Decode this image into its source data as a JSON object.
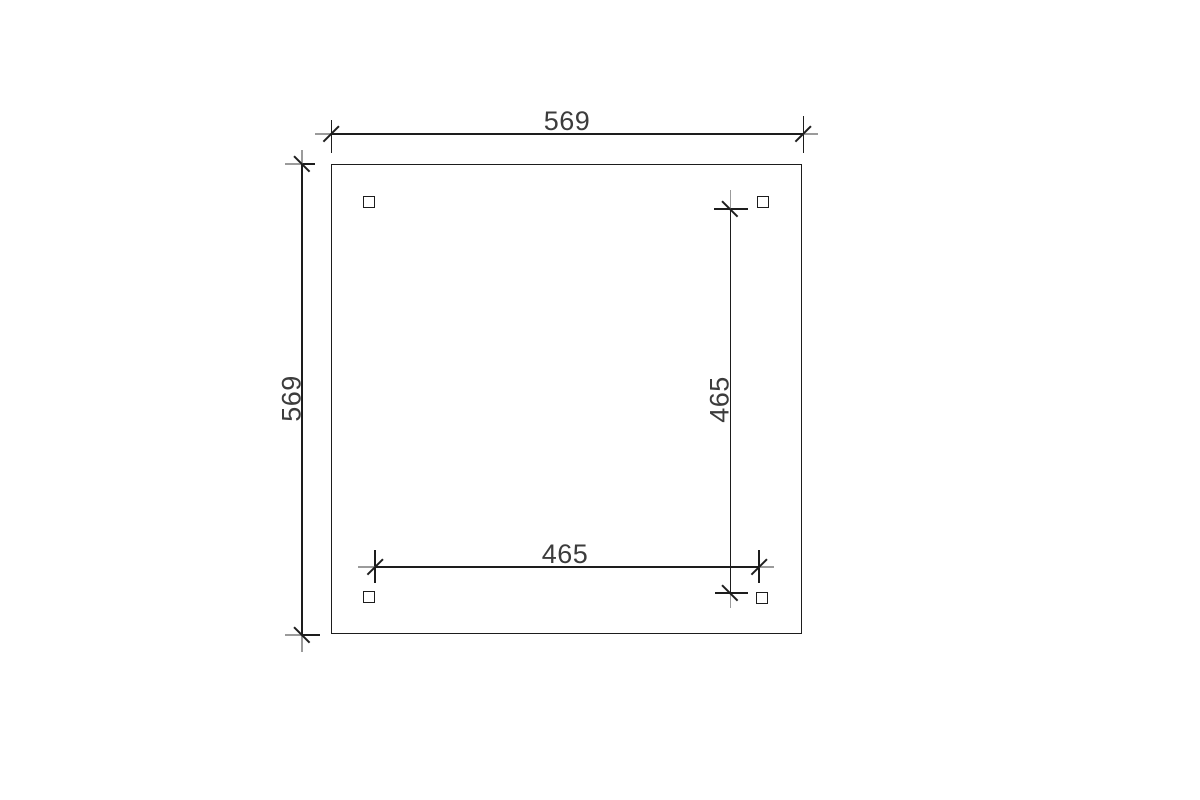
{
  "drawing": {
    "type": "plan-top-view",
    "colors": {
      "bg": "#ffffff",
      "line": "#1d1d1d",
      "overshoot": "#9b9b9b",
      "text": "#3c3c3c"
    },
    "dimensions": [
      {
        "id": "overall-width",
        "label": "569",
        "axis": "horizontal",
        "location": "top"
      },
      {
        "id": "overall-depth",
        "label": "569",
        "axis": "vertical",
        "location": "left"
      },
      {
        "id": "post-span-depth",
        "label": "465",
        "axis": "vertical",
        "location": "inner-right"
      },
      {
        "id": "post-span-width",
        "label": "465",
        "axis": "horizontal",
        "location": "inner-bottom"
      }
    ],
    "posts": [
      {
        "id": "top-left"
      },
      {
        "id": "top-right"
      },
      {
        "id": "bottom-left"
      },
      {
        "id": "bottom-right"
      }
    ]
  }
}
